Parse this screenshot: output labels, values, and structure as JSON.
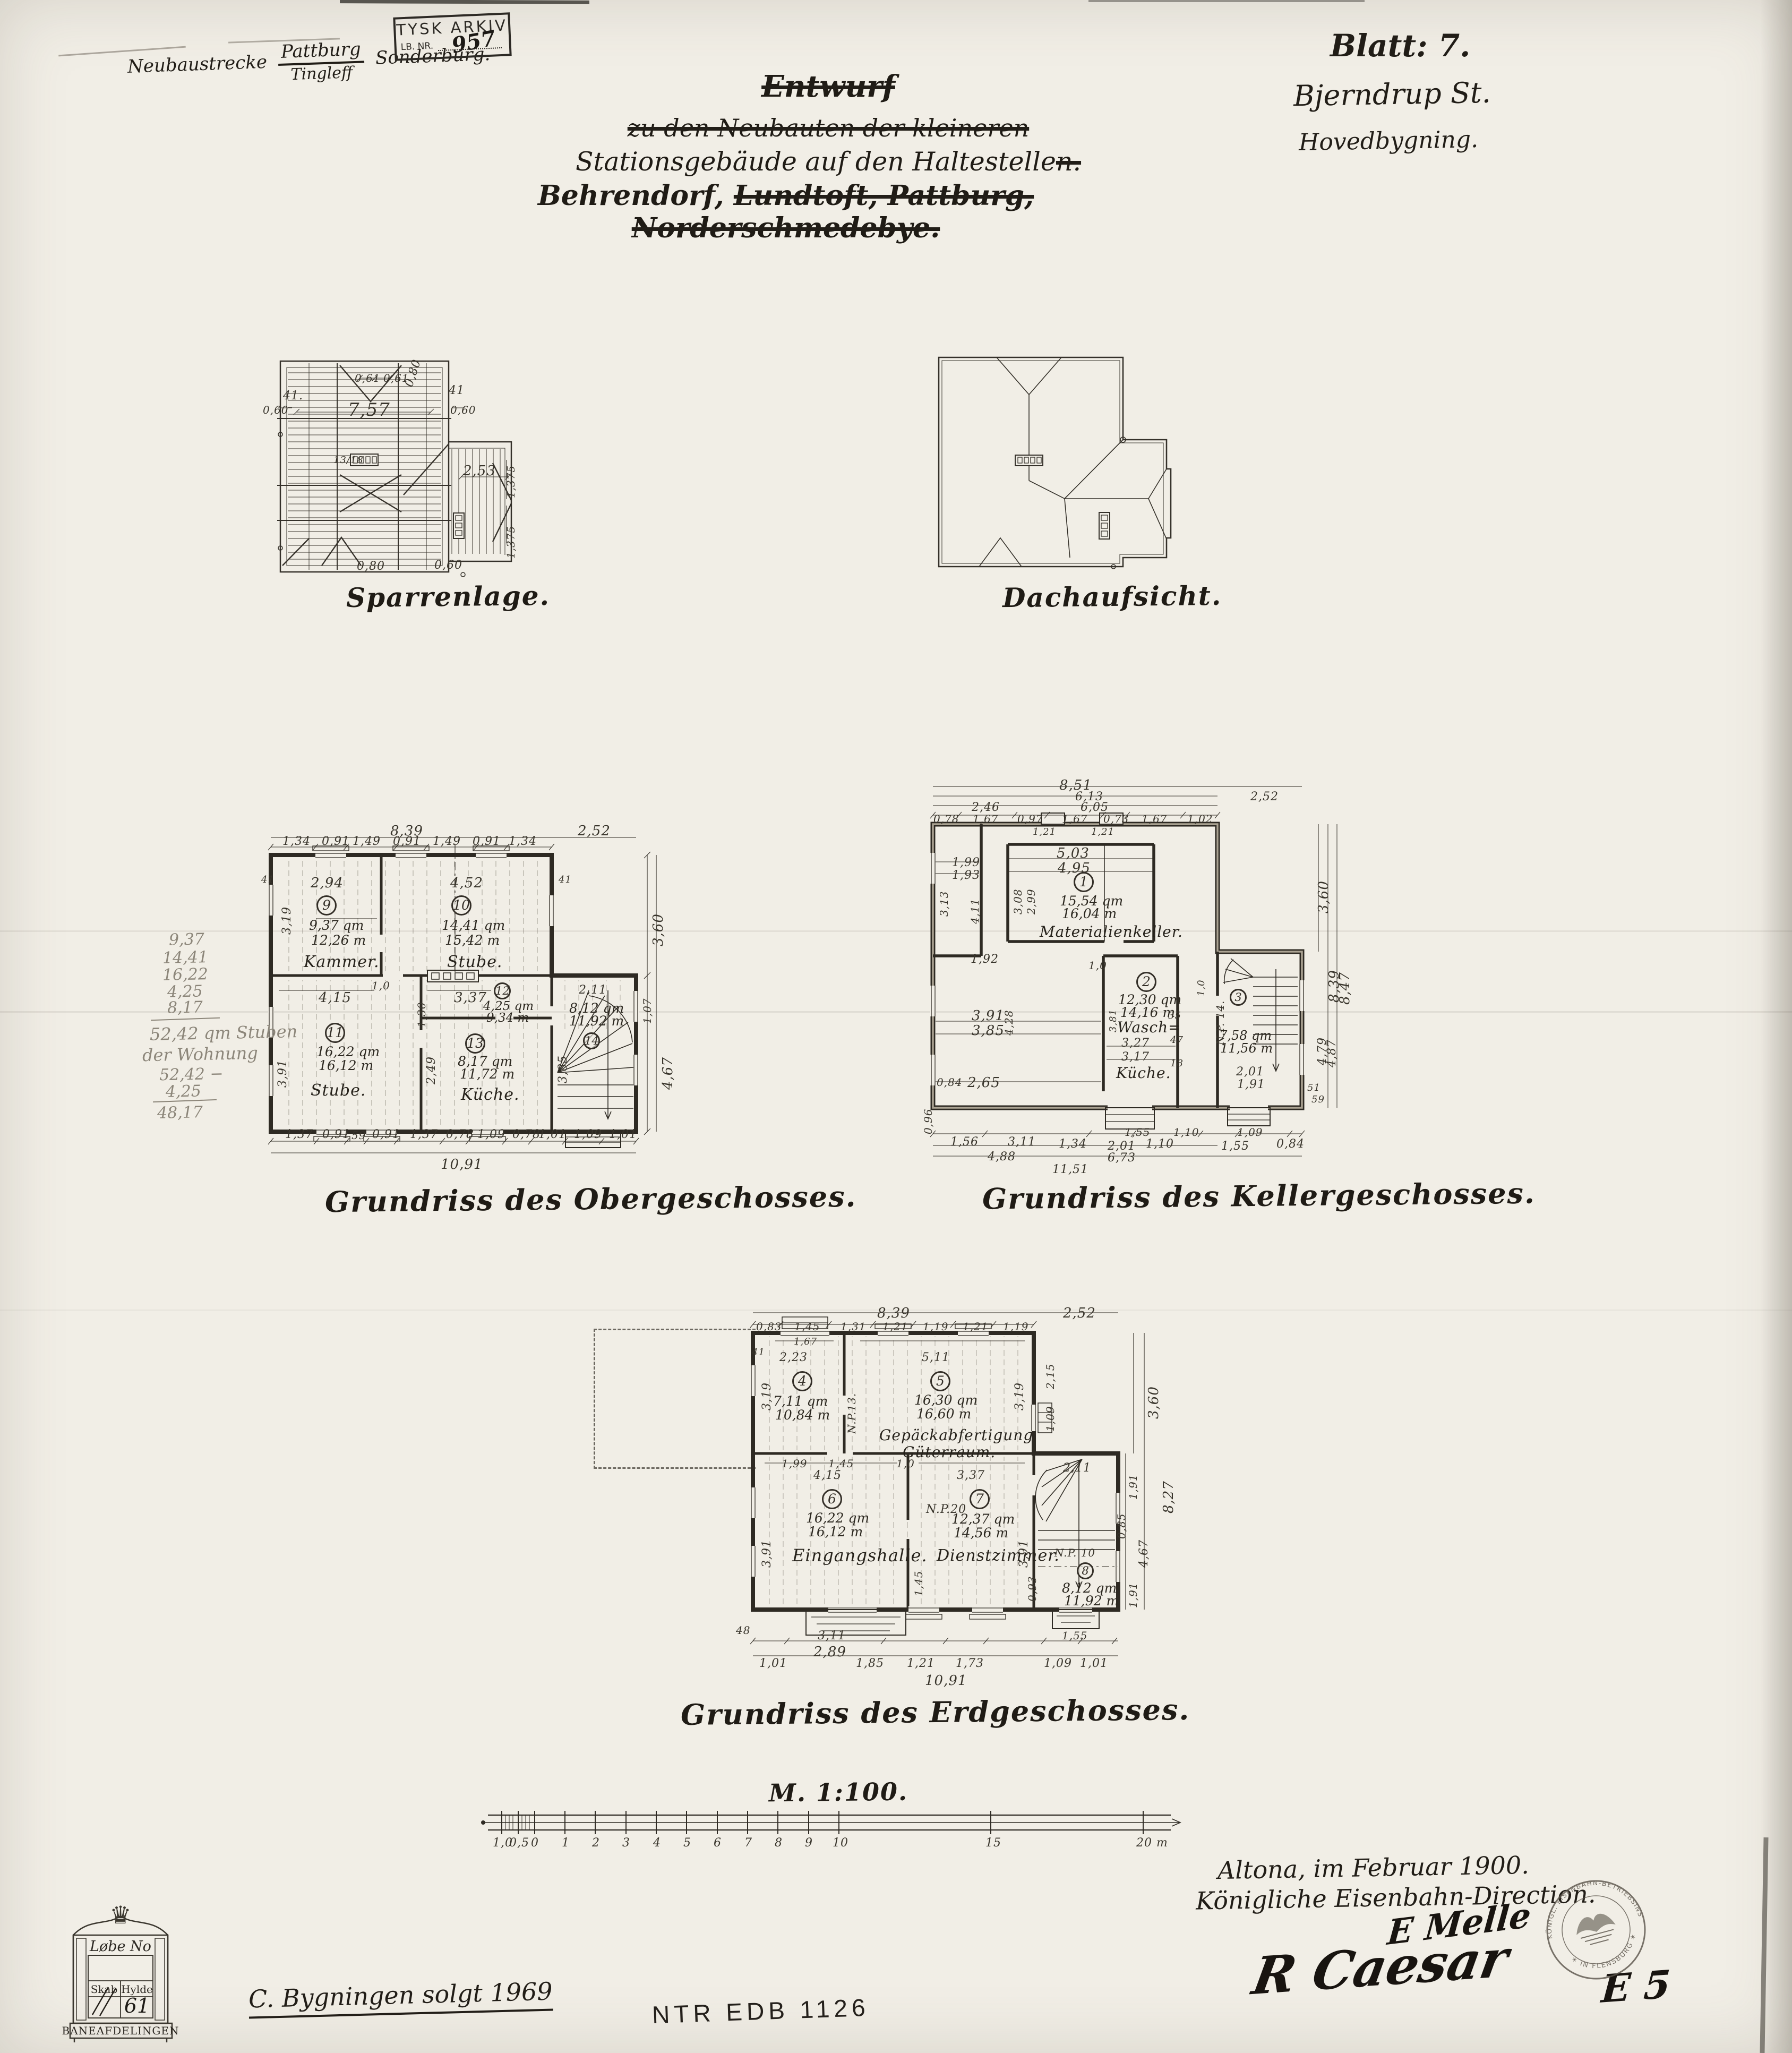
{
  "page": {
    "paper": "#f1eee6",
    "ink": "#26221c",
    "pencil": "#8c867a"
  },
  "corner": {
    "prefix": "Neubaustrecke",
    "over": "Pattburg",
    "under": "Tingleff",
    "suffix": "Sonderburg."
  },
  "tysk": {
    "l1": "TYSK ARKIV",
    "l2": "LB. NR.",
    "no": "957"
  },
  "title": {
    "l1": "Entwurf",
    "l2": "zu den Neubauten der kleineren",
    "l3a": "Stationsgebäude auf den Haltestelle",
    "l3b": "n.",
    "l4a": "Behrendorf,",
    "l4b": "Lundtoft, Pattburg, Norderschmedebye."
  },
  "sheet": {
    "blatt": "Blatt: 7.",
    "station": "Bjerndrup St.",
    "building": "Hovedbygning."
  },
  "captions": {
    "sparren": "Sparrenlage.",
    "dach": "Dachaufsicht.",
    "ober": "Grundriss des Obergeschosses.",
    "keller": "Grundriss des Kellergeschosses.",
    "erd": "Grundriss des Erdgeschosses."
  },
  "sparren": {
    "d": {
      "w": "7,57",
      "a1": "0,61",
      "a2": "0,61",
      "v": "0,80",
      "n1": "41.",
      "n2": "41",
      "s1": "0,60",
      "s2": "0,60",
      "wing": "2,53",
      "h1": "1,375",
      "h2": "1,375",
      "ratio": "13/18",
      "b1": "0,80",
      "b2": "0,60"
    }
  },
  "ober": {
    "rooms": [
      {
        "no": "9",
        "area": "9,37 qm",
        "umf": "12,26 m",
        "name": "Kammer."
      },
      {
        "no": "10",
        "area": "14,41 qm",
        "umf": "15,42 m",
        "name": "Stube."
      },
      {
        "no": "11",
        "area": "16,22 qm",
        "umf": "16,12 m",
        "name": "Stube."
      },
      {
        "no": "12",
        "area": "4,25 qm",
        "umf": "9,34 m"
      },
      {
        "no": "13",
        "area": "8,17 qm",
        "umf": "11,72 m",
        "name": "Küche."
      },
      {
        "no": "14",
        "area": "8,12 qm",
        "umf": "11,92 m"
      }
    ],
    "d": {
      "t1": "8,39",
      "t2": "2,52",
      "s1": "1,34",
      "s2": "0,91",
      "s3": "1,49",
      "s4": "0,91",
      "s5": "1,49",
      "s6": "0,91",
      "s7": "1,34",
      "i1": "2,94",
      "i2": "4,52",
      "i3": "3,19",
      "i4": "4,15",
      "i5": "3,37",
      "i6": "3,91",
      "i7": "2,49",
      "i8": "2,11",
      "i9": "3,85",
      "i10": "1,30",
      "r1": "3,60",
      "r2": "1,07",
      "r3": "4,67",
      "b1": "1,37",
      "b2": "0,91",
      "b3": "59",
      "b4": "0,91",
      "b5": "1,37",
      "b6": "0,78",
      "b7": "1,09",
      "b8": "0,78",
      "b9": "1,01",
      "b10": "1,09",
      "b11": "1,01",
      "tot": "10,91",
      "n1": "41",
      "n2": "41",
      "p1": "1,0"
    }
  },
  "keller": {
    "rooms": [
      {
        "no": "1",
        "area": "15,54 qm",
        "umf": "16,04 m",
        "name": "Materialienkeller."
      },
      {
        "no": "2",
        "area": "12,30 qm",
        "umf": "14,16 m",
        "name": "Wasch=",
        "name2": "Küche."
      },
      {
        "no": "3",
        "area": "7,58 qm",
        "umf": "11,56 m",
        "np": "N.P. 14."
      }
    ],
    "d": {
      "t1": "8,51",
      "t2": "6,13",
      "t3": "2,52",
      "t4": "2,46",
      "t5": "6,05",
      "s1": "0,78",
      "s2": "1,67",
      "s3": "0,97",
      "s4": "1,67",
      "s5": "0,73",
      "s6": "1,67",
      "s7": "1,02",
      "w1": "1,21",
      "w2": "1,21",
      "i1": "5,03",
      "i2": "4,95",
      "i3": "3,08",
      "i4": "2,99",
      "i5": "1,99",
      "i6": "1,93",
      "i7": "3,13",
      "i8": "4,11",
      "i9": "1,92",
      "i10": "3,91",
      "i11": "3,85",
      "i12": "2,65",
      "i13": "4,28",
      "i14": "3,27",
      "i15": "3,17",
      "i16": "2,01",
      "i17": "1,91",
      "i18": "3,81",
      "i19": "0,84",
      "r1": "3,60",
      "r2": "8,39",
      "r3": "8,47",
      "r4": "4,79",
      "r5": "4,87",
      "b1": "1,56",
      "b2": "3,11",
      "b3": "1,34",
      "b4": "2,01",
      "b5": "1,10",
      "b6": "1,55",
      "b7": "0,84",
      "b8": "4,88",
      "b9": "11,51",
      "b10": "6,73",
      "st1": "1,55",
      "st2": "1,10",
      "st3": "1,09",
      "sm1": "35",
      "sm2": "47",
      "sm3": "18",
      "sm4": "51",
      "sm5": "59",
      "p1": "1,0",
      "p2": "1,0",
      "v1": "0,96"
    }
  },
  "erd": {
    "rooms": [
      {
        "no": "4",
        "area": "7,11 qm",
        "umf": "10,84 m"
      },
      {
        "no": "5",
        "area": "16,30 qm",
        "umf": "16,60 m",
        "name": "Gepäckabfertigung",
        "name2": "Güterraum."
      },
      {
        "no": "6",
        "area": "16,22 qm",
        "umf": "16,12 m",
        "name": "Eingangshalle."
      },
      {
        "no": "7",
        "area": "12,37 qm",
        "umf": "14,56 m",
        "name": "Dienstzimmer.",
        "np": "N.P.20"
      },
      {
        "no": "8",
        "area": "8,12 qm",
        "umf": "11,92 m",
        "np": "N.P. 10"
      }
    ],
    "d": {
      "t1": "8,39",
      "t2": "2,52",
      "s1": "0,83",
      "s2": "1,45",
      "s3": "1,31",
      "s4": "1,21",
      "s5": "1,19",
      "s6": "1,21",
      "s7": "1,19",
      "w1": "1,67",
      "n1": "41",
      "i1": "2,23",
      "i2": "5,11",
      "i3": "3,19",
      "i4": "3,19",
      "i5": "4,15",
      "i6": "3,37",
      "i7": "3,91",
      "i8": "3,91",
      "i9": "2,11",
      "i10": "1,45",
      "i11": "0,93",
      "np1": "N.P.13.",
      "m1": "1,99",
      "m2": "1,45",
      "m3": "1,0",
      "r1": "2,15",
      "r2": "1,09",
      "r3": "3,60",
      "r4": "8,27",
      "r5": "1,91",
      "r6": "4,67",
      "r7": "1,91",
      "v2": "0,85",
      "b1": "3,11",
      "b2": "2,89",
      "b3": "48",
      "b4": "1,01",
      "b5": "1,85",
      "b6": "1,21",
      "b7": "1,73",
      "b8": "1,09",
      "b9": "1,01",
      "b10": "1,55",
      "tot": "10,91"
    }
  },
  "scale_bar": {
    "caption": "M. 1:100.",
    "ticks": [
      "1,0",
      "0,5",
      "0",
      "1",
      "2",
      "3",
      "4",
      "5",
      "6",
      "7",
      "8",
      "9",
      "10",
      "15",
      "20 m"
    ]
  },
  "pencil": [
    "9,37",
    "14,41",
    "16,22",
    "4,25",
    "8,17",
    "52,42 qm Stuben",
    "der Wohnung",
    "52,42 −",
    "4,25",
    "48,17"
  ],
  "footer": {
    "place": "Altona, im Februar 1900.",
    "authority": "Königliche Eisenbahn-Direction.",
    "sig1": "R Caesar",
    "sig2": "E Melle",
    "mark": "E 5"
  },
  "round_stamp": {
    "top": "KÖNIGL. EISENBAHN-BETRIEBSINSPECTION",
    "bottom": "✶ IN FLENSBURG ✶"
  },
  "cabinet": {
    "crown": "♛",
    "header": "Løbe No",
    "skab": "Skab",
    "hylde": "Hylde",
    "value": "61",
    "footer": "BANEAFDELINGEN"
  },
  "notes": {
    "sold": "C. Bygningen solgt 1969",
    "ntr": "NTR  EDB  1126"
  }
}
